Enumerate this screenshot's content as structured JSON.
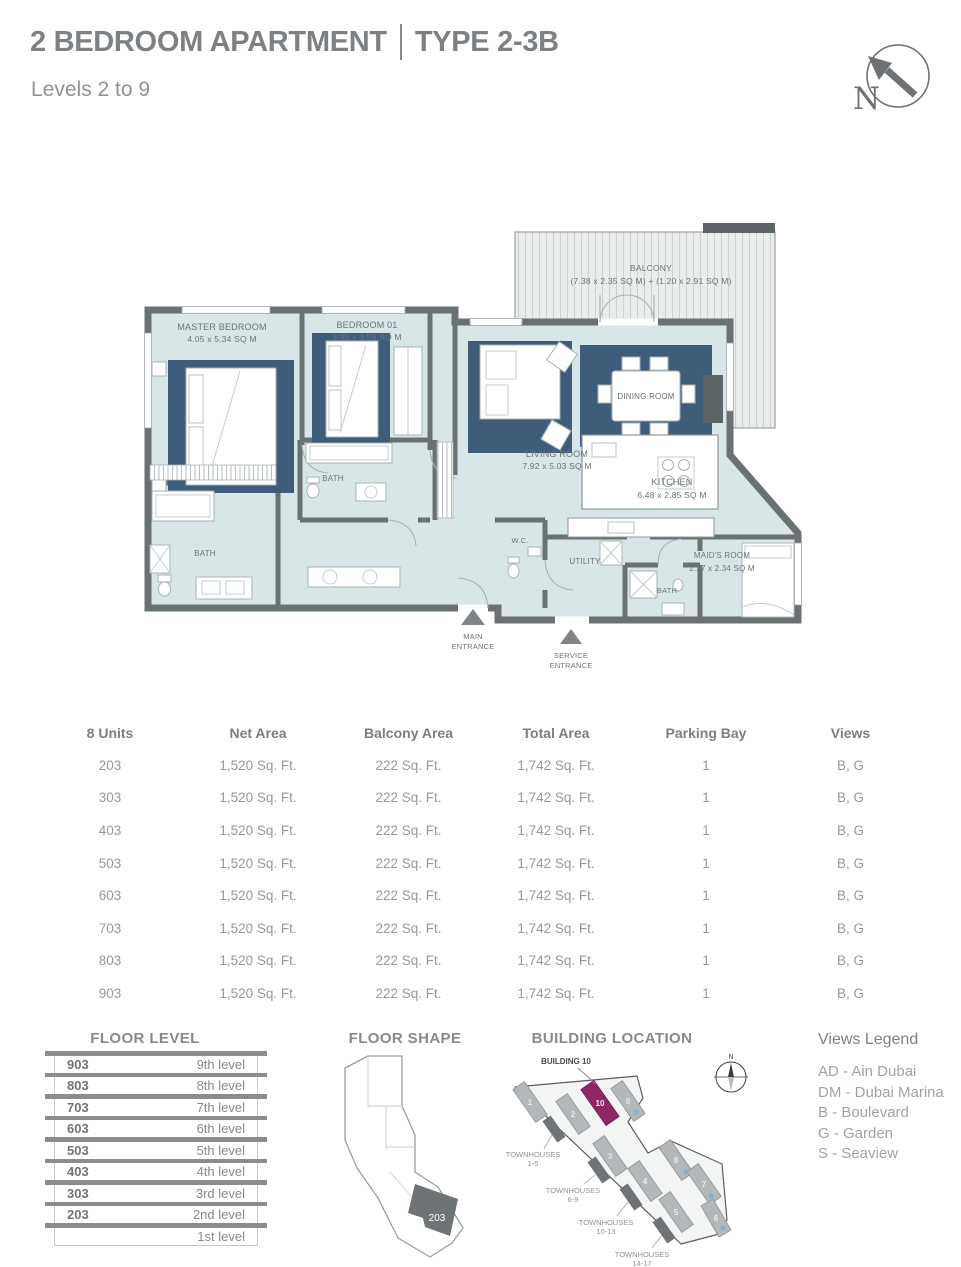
{
  "header": {
    "title_left": "2 BEDROOM APARTMENT",
    "title_right": "TYPE 2-3B",
    "subtitle": "Levels 2 to 9",
    "compass_n": "N"
  },
  "floor_plan": {
    "balcony_name": "BALCONY",
    "balcony_dims": "(7.38 x 2.35 SQ M) + (1.20 x 2.91 SQ M)",
    "master_name": "MASTER BEDROOM",
    "master_dims": "4.05 x 5.34 SQ M",
    "bedroom01_name": "BEDROOM 01",
    "bedroom01_dims": "3.95 x 3.59 SQ M",
    "living_name": "LIVING ROOM",
    "living_dims": "7.92 x 5.03 SQ M",
    "dining_name": "DINING ROOM",
    "kitchen_name": "KITCHEN",
    "kitchen_dims": "6.48 x 2.85 SQ M",
    "maids_name": "MAID'S ROOM",
    "maids_dims": "2.27 x 2.34 SQ M",
    "bath": "BATH",
    "wc": "W.C.",
    "utility": "UTILITY",
    "main_entrance_1": "MAIN",
    "main_entrance_2": "ENTRANCE",
    "service_entrance_1": "SERVICE",
    "service_entrance_2": "ENTRANCE"
  },
  "units_table": {
    "headers": [
      "8 Units",
      "Net Area",
      "Balcony Area",
      "Total Area",
      "Parking Bay",
      "Views"
    ],
    "rows": [
      {
        "unit": "203",
        "net": "1,520 Sq. Ft.",
        "balcony": "222 Sq. Ft.",
        "total": "1,742 Sq. Ft.",
        "parking": "1",
        "views": "B, G"
      },
      {
        "unit": "303",
        "net": "1,520 Sq. Ft.",
        "balcony": "222 Sq. Ft.",
        "total": "1,742 Sq. Ft.",
        "parking": "1",
        "views": "B, G"
      },
      {
        "unit": "403",
        "net": "1,520 Sq. Ft.",
        "balcony": "222 Sq. Ft.",
        "total": "1,742 Sq. Ft.",
        "parking": "1",
        "views": "B, G"
      },
      {
        "unit": "503",
        "net": "1,520 Sq. Ft.",
        "balcony": "222 Sq. Ft.",
        "total": "1,742 Sq. Ft.",
        "parking": "1",
        "views": "B, G"
      },
      {
        "unit": "603",
        "net": "1,520 Sq. Ft.",
        "balcony": "222 Sq. Ft.",
        "total": "1,742 Sq. Ft.",
        "parking": "1",
        "views": "B, G"
      },
      {
        "unit": "703",
        "net": "1,520 Sq. Ft.",
        "balcony": "222 Sq. Ft.",
        "total": "1,742 Sq. Ft.",
        "parking": "1",
        "views": "B, G"
      },
      {
        "unit": "803",
        "net": "1,520 Sq. Ft.",
        "balcony": "222 Sq. Ft.",
        "total": "1,742 Sq. Ft.",
        "parking": "1",
        "views": "B, G"
      },
      {
        "unit": "903",
        "net": "1,520 Sq. Ft.",
        "balcony": "222 Sq. Ft.",
        "total": "1,742 Sq. Ft.",
        "parking": "1",
        "views": "B, G"
      }
    ]
  },
  "floor_level": {
    "title": "FLOOR LEVEL",
    "rows": [
      {
        "unit": "903",
        "level": "9th level"
      },
      {
        "unit": "803",
        "level": "8th level"
      },
      {
        "unit": "703",
        "level": "7th level"
      },
      {
        "unit": "603",
        "level": "6th level"
      },
      {
        "unit": "503",
        "level": "5th level"
      },
      {
        "unit": "403",
        "level": "4th level"
      },
      {
        "unit": "303",
        "level": "3rd level"
      },
      {
        "unit": "203",
        "level": "2nd level"
      },
      {
        "unit": "",
        "level": "1st level"
      }
    ]
  },
  "floor_shape": {
    "title": "FLOOR SHAPE",
    "unit": "203"
  },
  "building_location": {
    "title": "BUILDING LOCATION",
    "building_label": "BUILDING 10",
    "compass_n": "N",
    "buildings": [
      {
        "n": "1"
      },
      {
        "n": "2"
      },
      {
        "n": "10"
      },
      {
        "n": "9"
      },
      {
        "n": "3"
      },
      {
        "n": "4"
      },
      {
        "n": "5"
      },
      {
        "n": "8"
      },
      {
        "n": "7"
      },
      {
        "n": "6"
      }
    ],
    "townhouses": [
      {
        "l1": "TOWNHOUSES",
        "l2": "1-5"
      },
      {
        "l1": "TOWNHOUSES",
        "l2": "6-9"
      },
      {
        "l1": "TOWNHOUSES",
        "l2": "10-13"
      },
      {
        "l1": "TOWNHOUSES",
        "l2": "14-17"
      }
    ]
  },
  "views_legend": {
    "title": "Views Legend",
    "items": [
      "AD - Ain Dubai",
      "DM - Dubai Marina",
      "B - Boulevard",
      "G - Garden",
      "S - Seaview"
    ]
  },
  "colors": {
    "room_fill": "#d9e6e8",
    "accent_blue": "#3f5c7a",
    "wall_gray": "#6a7173",
    "highlight_maroon": "#8e2764"
  }
}
